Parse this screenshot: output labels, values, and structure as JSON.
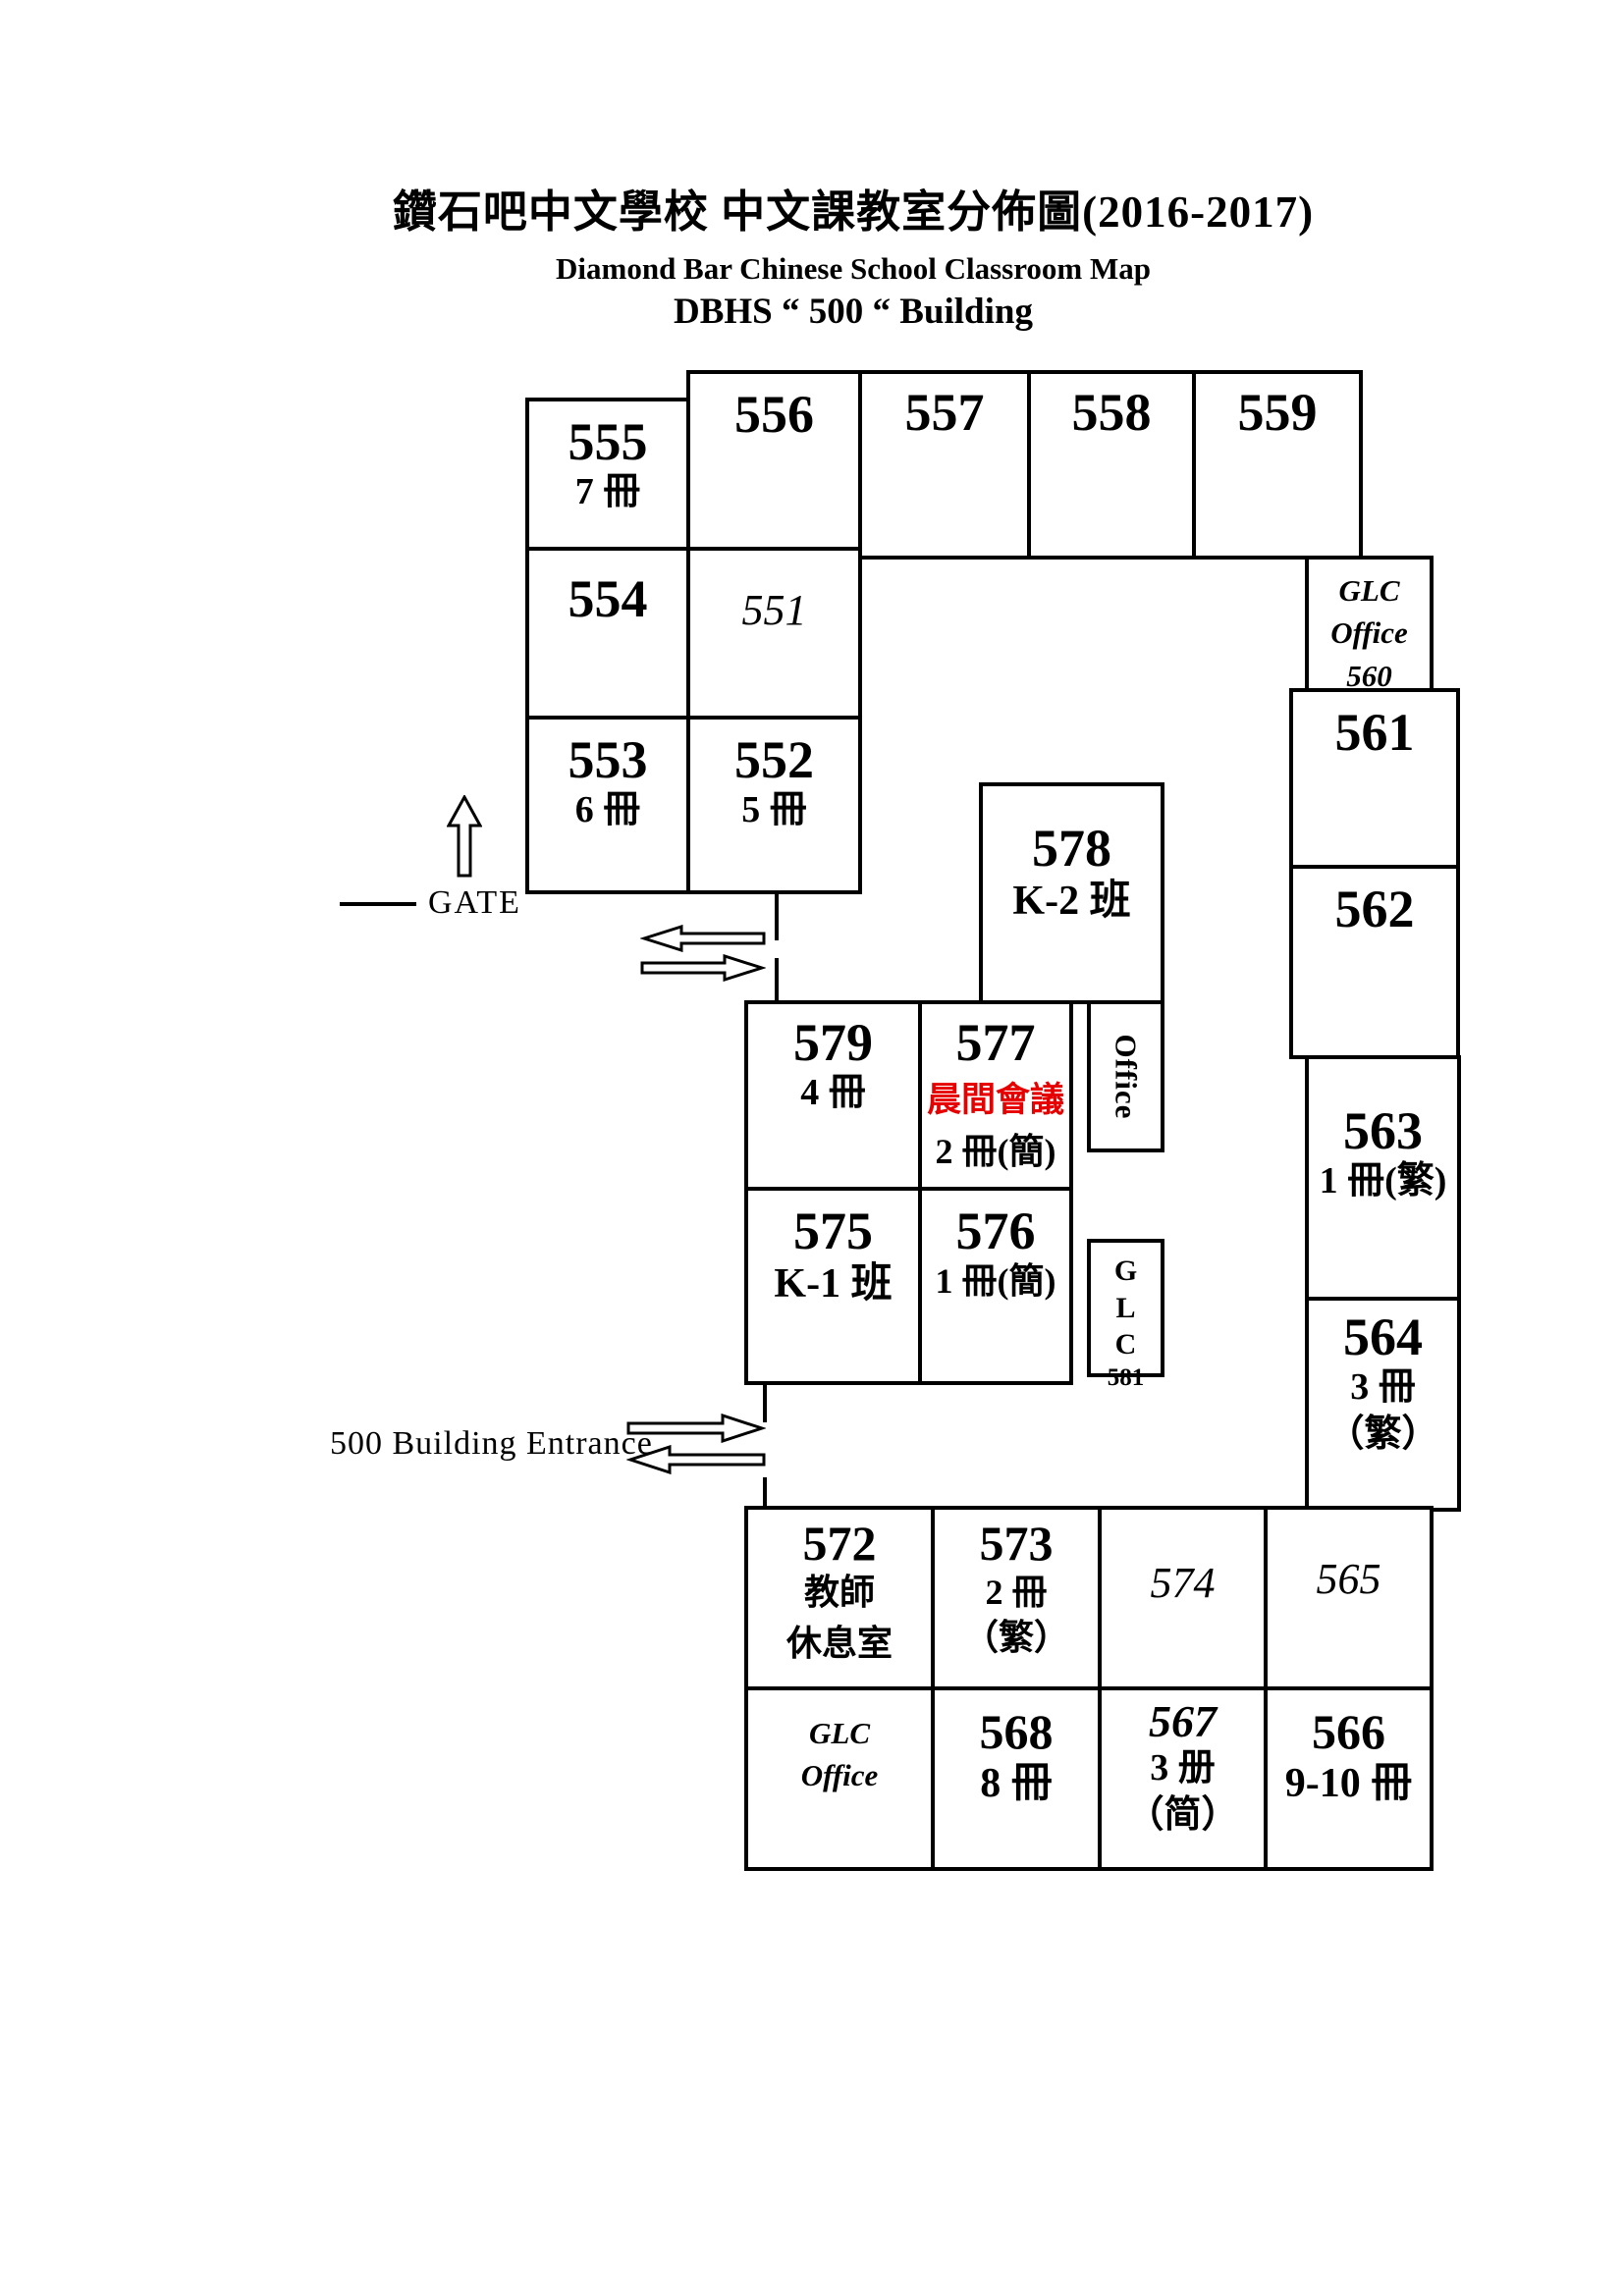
{
  "title": {
    "line1": "鑽石吧中文學校 中文課教室分佈圖(2016-2017)",
    "line2": "Diamond Bar Chinese School Classroom Map",
    "line3": "DBHS “ 500 “ Building"
  },
  "labels": {
    "gate": "GATE",
    "entrance": "500 Building Entrance"
  },
  "rooms": {
    "r555": {
      "number": "555",
      "sub": "7 冊"
    },
    "r554": {
      "number": "554"
    },
    "r553": {
      "number": "553",
      "sub": "6 冊"
    },
    "r556": {
      "number": "556"
    },
    "r551": {
      "number": "551"
    },
    "r552": {
      "number": "552",
      "sub": "5 冊"
    },
    "r557": {
      "number": "557"
    },
    "r558": {
      "number": "558"
    },
    "r559": {
      "number": "559"
    },
    "glc560": {
      "l1": "GLC",
      "l2": "Office",
      "l3": "560"
    },
    "r561": {
      "number": "561"
    },
    "r562": {
      "number": "562"
    },
    "r563": {
      "number": "563",
      "sub": "1 冊(繁)"
    },
    "r564": {
      "number": "564",
      "sub": "3 冊",
      "sub2": "（繁）"
    },
    "r578": {
      "number": "578",
      "sub": "K-2 班"
    },
    "r579": {
      "number": "579",
      "sub": "4 冊"
    },
    "r577": {
      "number": "577",
      "alert": "晨間會議",
      "sub": "2 冊(簡)"
    },
    "office": {
      "label": "Office"
    },
    "r575": {
      "number": "575",
      "sub": "K-1 班"
    },
    "r576": {
      "number": "576",
      "sub": "1 冊(簡)"
    },
    "glc581": {
      "l1": "G",
      "l2": "L",
      "l3": "C",
      "l4": "581"
    },
    "r572": {
      "number": "572",
      "sub": "教師",
      "sub2": "休息室"
    },
    "r573": {
      "number": "573",
      "sub": "2 冊",
      "sub2": "（繁）"
    },
    "r574": {
      "number": "574"
    },
    "r565": {
      "number": "565"
    },
    "glc_sw": {
      "l1": "GLC",
      "l2": "Office"
    },
    "r568": {
      "number": "568",
      "sub": "8 冊"
    },
    "r567": {
      "number": "567",
      "sub": "3 册",
      "sub2": "（简）"
    },
    "r566": {
      "number": "566",
      "sub": "9-10 冊"
    }
  },
  "colors": {
    "wall": "#000000",
    "highlight": "#e60000",
    "background": "#ffffff"
  }
}
